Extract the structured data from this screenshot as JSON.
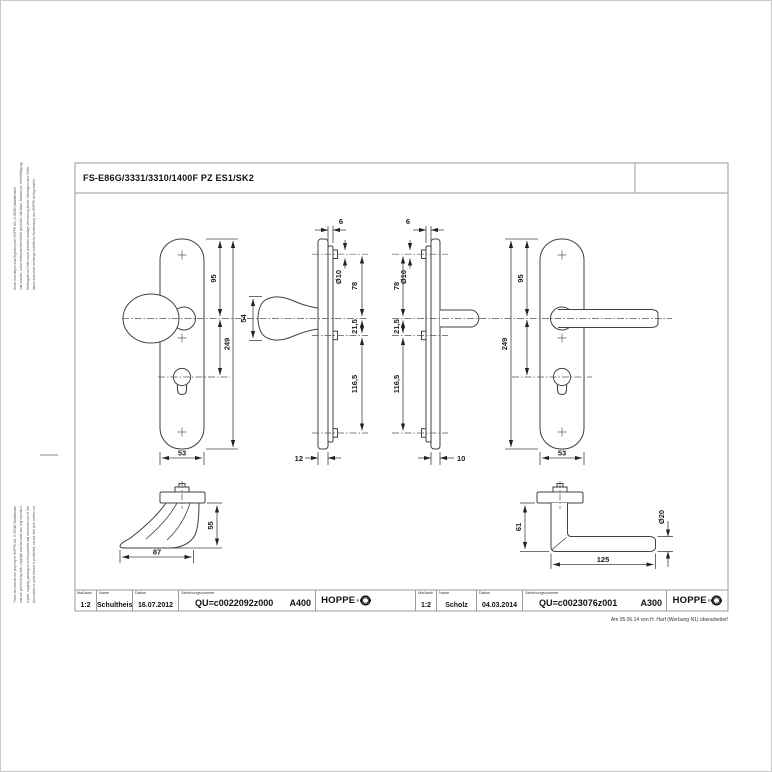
{
  "title_bar": {
    "title": "FS-E86G/3331/3310/1400F PZ ES1/SK2"
  },
  "revision_note": "Am 05.06.14 von H. Harf (Werbung N1) überarbeitet!",
  "side_notes": {
    "german_lines": [
      "Diese Unterlagen sind Eigentum der HOPPE AG, D-35260 Stadtallendorf",
      "und urheber- sowie wettbewerbsrechtlich geschützt. Nachbau, Nachdruck, Vervielfältigung,",
      "Weitergabe an Dritte sowie jedwede sonstige Verwertung dieser Unterlagen oder Teilen",
      "davon sind ohne vorherige schriftliche Zustimmung von HOPPE nicht gestattet."
    ],
    "english_lines": [
      "These documents are property of HOPPE AG, D-35260 Stadtallendorf",
      "and are protected by both copyright and fair trade law. Any reproduction,",
      "reprint, copying, passing on to third parties and whichever use of these",
      "documents or parts thereof is prohibited, except with prior written consent of HOPPE."
    ]
  },
  "title_blocks": [
    {
      "scale_label": "Maßstab",
      "scale_value": "1:2",
      "name_label": "Name",
      "name_value": "Schultheis",
      "date_label": "Datum",
      "date_value": "16.07.2012",
      "drawing_no_label": "Zeichnungsnummer",
      "drawing_no_value": "QU=c0022092z000",
      "sheet_code": "A400",
      "brand": "HOPPE",
      "brand_mark": "®"
    },
    {
      "scale_label": "Maßstab",
      "scale_value": "1:2",
      "name_label": "Name",
      "name_value": "Scholz",
      "date_label": "Datum",
      "date_value": "04.03.2014",
      "drawing_no_label": "Zeichnungsnummer",
      "drawing_no_value": "QU=c0023076z001",
      "sheet_code": "A300",
      "brand": "HOPPE",
      "brand_mark": "®"
    }
  ],
  "dims": {
    "lf95": "95",
    "lf249": "249",
    "lf53": "53",
    "k54": "54",
    "lp6": "6",
    "lpd10": "Ø10",
    "lp78": "78",
    "lp215": "21,5",
    "lp1165": "116,5",
    "lp12": "12",
    "rp6": "6",
    "rpd10": "Ø10",
    "rp78": "78",
    "rp215": "21,5",
    "rp1165": "116,5",
    "rp10": "10",
    "rf95": "95",
    "rf249": "249",
    "rf53": "53",
    "kd87": "87",
    "kd55": "55",
    "ld61": "61",
    "ld125": "125",
    "ldd20": "Ø20"
  },
  "colors": {
    "line": "#414141",
    "frame": "#9a9a9a",
    "centerline": "#555555",
    "text": "#111111"
  }
}
